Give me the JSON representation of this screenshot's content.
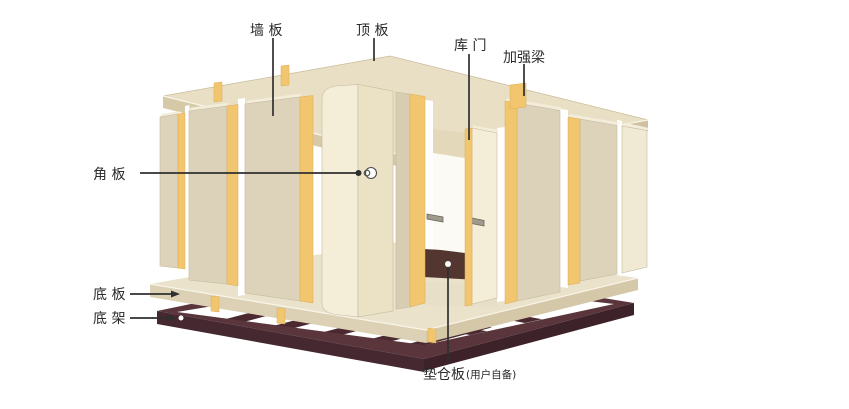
{
  "figure": {
    "type": "exploded-assembly-diagram",
    "subject": "cold storage room panel assembly"
  },
  "labels": {
    "wall_panel": "墙 板",
    "roof_panel": "顶 板",
    "door": "库 门",
    "reinforce_beam": "加强梁",
    "corner_panel": "角 板",
    "floor_panel": "底 板",
    "base_frame": "底 架",
    "pallet": "垫仓板",
    "pallet_note": "(用户自备)"
  },
  "colors": {
    "background": "#ffffff",
    "panel_beige": "#dcd2b9",
    "panel_cream": "#f4eed9",
    "strip_yellow": "#f2c66f",
    "roof_top": "#e8dfc5",
    "roof_edge": "#d6c9a7",
    "floor_top": "#eae2cb",
    "frame_maroon": "#4a2a2f",
    "pallet_brown": "#543630",
    "annotation_ink": "#2f2f2f"
  }
}
